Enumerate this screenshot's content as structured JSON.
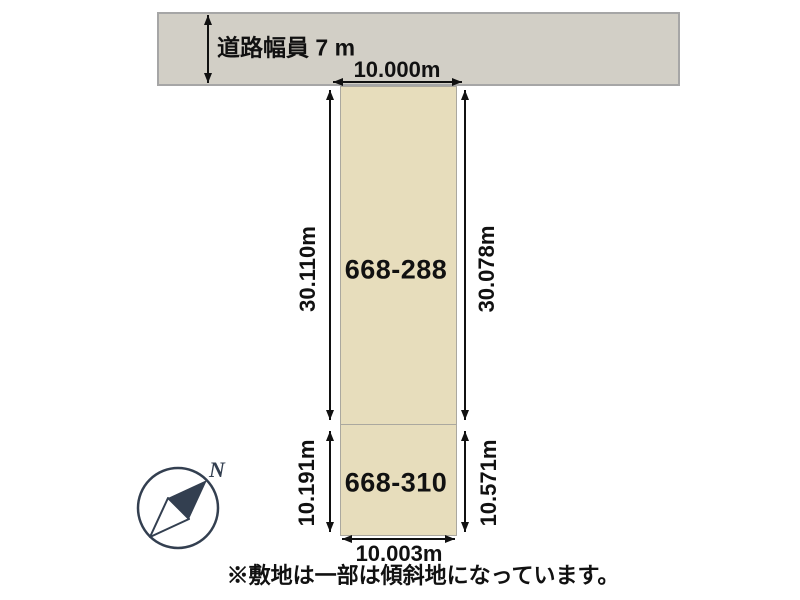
{
  "road": {
    "width_label": "道路幅員 7 m"
  },
  "plot": {
    "top_width_label": "10.000m",
    "bottom_width_label": "10.003m",
    "parcels": [
      {
        "id": "668-288",
        "left_depth_label": "30.110m",
        "right_depth_label": "30.078m"
      },
      {
        "id": "668-310",
        "left_depth_label": "10.191m",
        "right_depth_label": "10.571m"
      }
    ]
  },
  "compass": {
    "north_label": "N"
  },
  "note": "※敷地は一部は傾斜地になっています。",
  "colors": {
    "background": "#FFFFFF",
    "road_fill": "#D2CFC6",
    "road_border": "#A6A6A6",
    "parcel_fill": "#E7DDBC",
    "parcel_border": "#ABA89F",
    "dimension_line": "#111111",
    "text": "#111111",
    "compass": "#333F50"
  }
}
